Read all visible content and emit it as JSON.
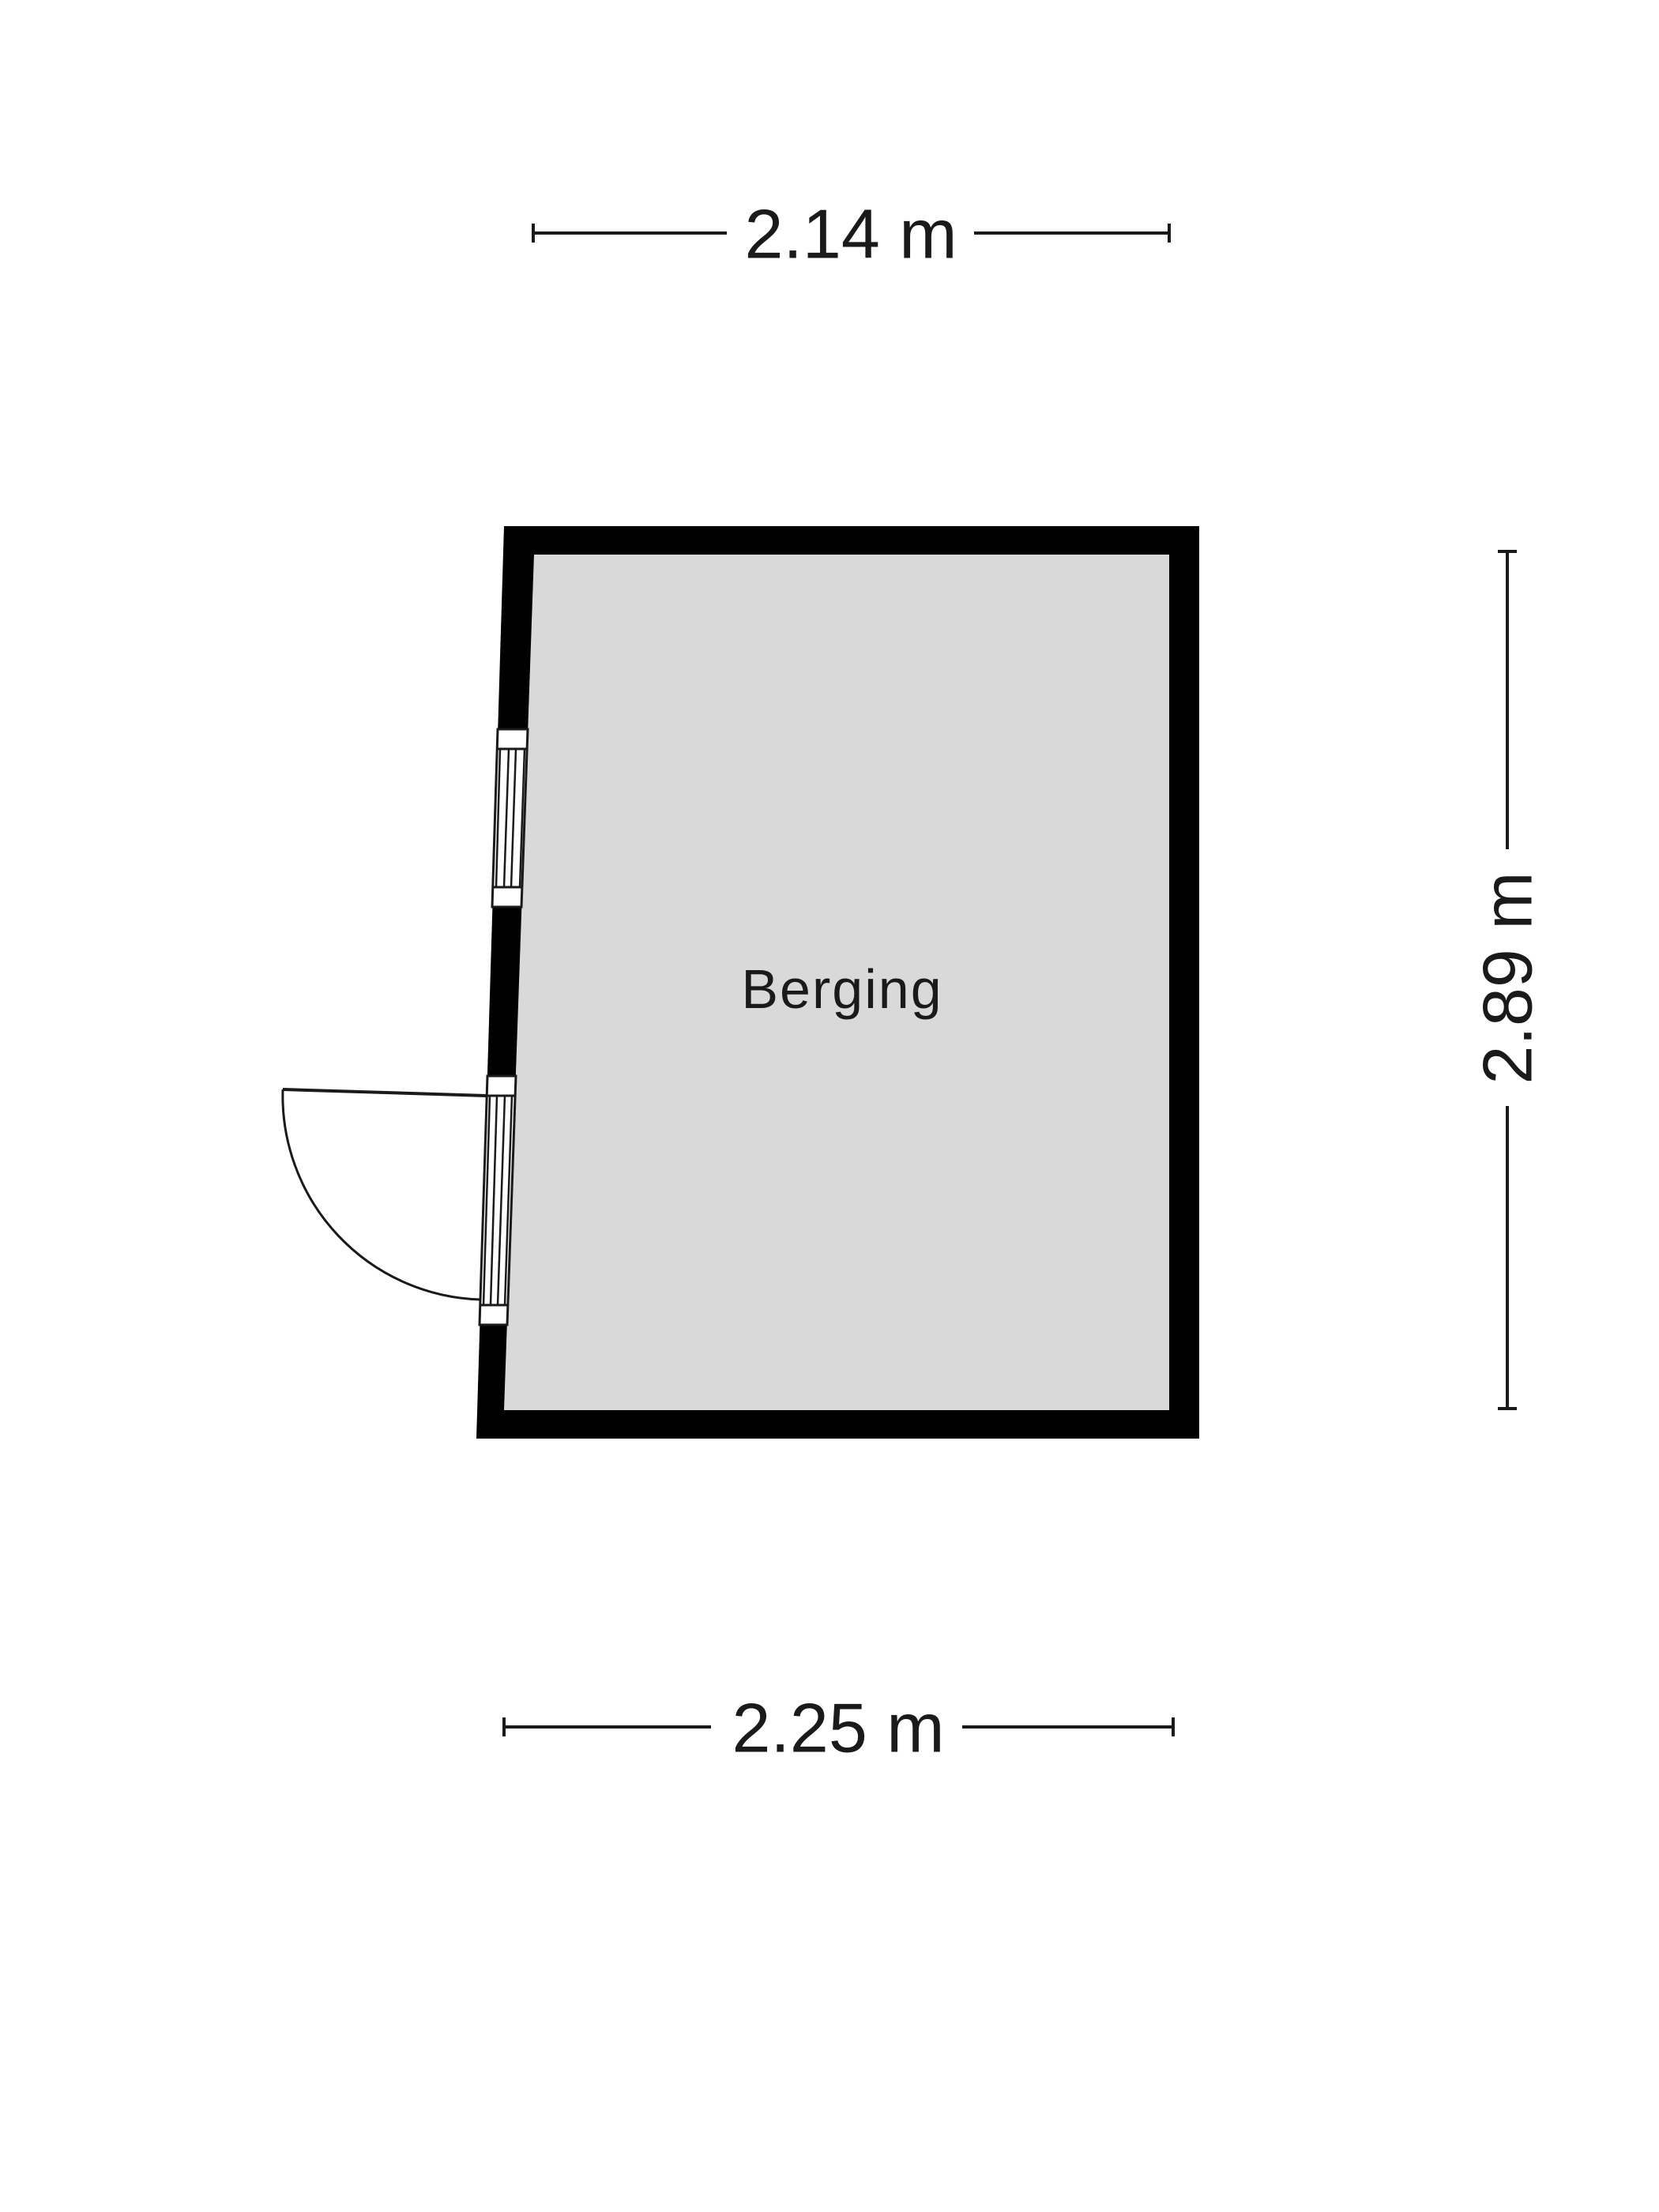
{
  "plan": {
    "room": {
      "label": "Berging"
    },
    "dimensions": {
      "top": "2.14 m",
      "right": "2.89 m",
      "bottom": "2.25 m"
    },
    "symbols": [
      "window",
      "glazed-door-with-swing"
    ]
  },
  "colors": {
    "wall": "#000000",
    "room_fill": "#d9d9d9",
    "ink": "#1a1a1a",
    "background": "#ffffff"
  }
}
